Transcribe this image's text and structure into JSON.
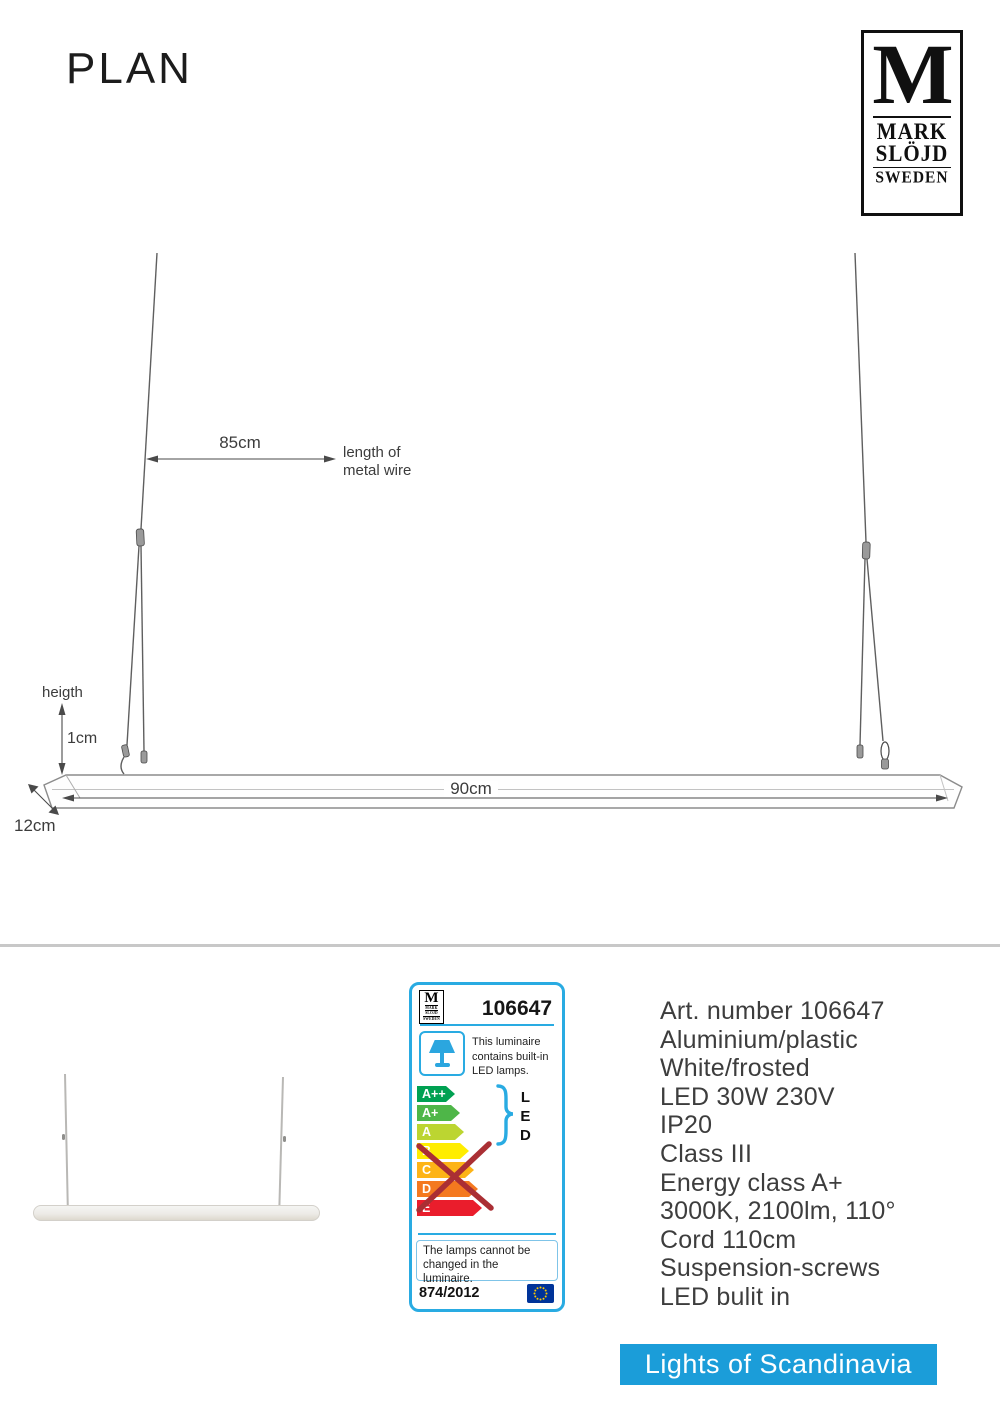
{
  "page": {
    "title": "PLAN"
  },
  "logo": {
    "m": "M",
    "line1": "MARK",
    "line2": "SLÖJD",
    "line3": "SWEDEN"
  },
  "diagram": {
    "wire_length_value": "85cm",
    "wire_note_line1": "length of",
    "wire_note_line2": "metal wire",
    "height_label": "heigth",
    "height_value": "1cm",
    "bar_length": "90cm",
    "bar_depth": "12cm"
  },
  "energy_label": {
    "article_number": "106647",
    "border_color": "#29abe2",
    "pictogram_color": "#2ba6df",
    "pictogram_icon": "table-lamp-icon",
    "luminaire_note": "This luminaire contains built-in LED lamps.",
    "classes": [
      {
        "label": "A++",
        "color": "#00a152"
      },
      {
        "label": "A+",
        "color": "#4eb648"
      },
      {
        "label": "A",
        "color": "#bcd531"
      },
      {
        "label": "B",
        "color": "#ffed00"
      },
      {
        "label": "C",
        "color": "#fdb417"
      },
      {
        "label": "D",
        "color": "#f4791f"
      },
      {
        "label": "E",
        "color": "#ea1d2c"
      }
    ],
    "led_group": [
      "L",
      "E",
      "D"
    ],
    "cross_color": "#aa2f34",
    "lamps_note": "The lamps cannot be changed in the luminaire.",
    "regulation": "874/2012",
    "eu_flag_icon": "eu-flag-icon",
    "eu_flag": {
      "background": "#003399",
      "stars": "#ffcc00"
    }
  },
  "specs": {
    "lines": [
      "Art. number 106647",
      "Aluminium/plastic",
      "White/frosted",
      "LED 30W 230V",
      "IP20",
      "Class III",
      "Energy class A+",
      "3000K, 2100lm, 110°",
      "Cord 110cm",
      "Suspension-screws",
      "LED bulit in"
    ]
  },
  "banner": {
    "text": "Lights of Scandinavia",
    "color": "#1b9dd9"
  }
}
